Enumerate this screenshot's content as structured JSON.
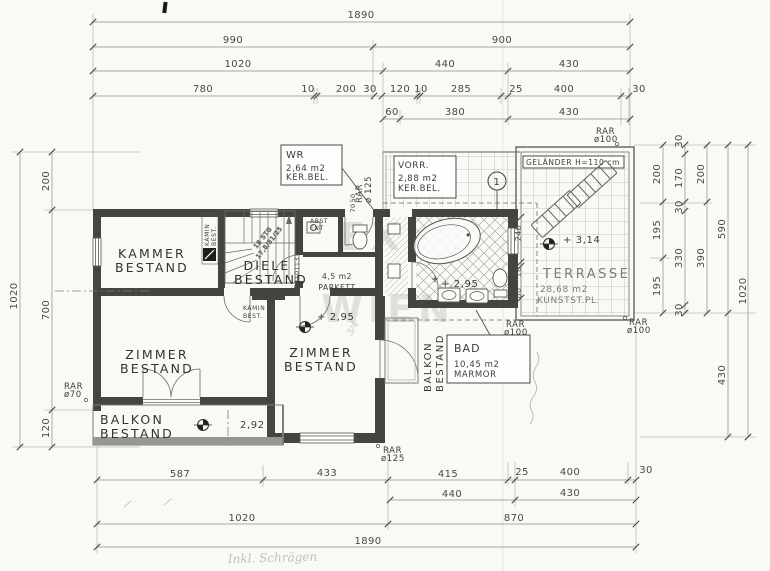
{
  "rooms": {
    "kammer": {
      "lines": [
        "KAMMER",
        "BESTAND"
      ]
    },
    "diele": {
      "lines": [
        "DIELE",
        "BESTAND"
      ]
    },
    "zimmer": {
      "lines": [
        "ZIMMER",
        "BESTAND"
      ]
    },
    "balkon": {
      "lines": [
        "BALKON",
        "BESTAND"
      ]
    },
    "wr": {
      "lines": [
        "WR",
        "2,64 m2",
        "KER.BEL."
      ]
    },
    "vorr": {
      "lines": [
        "VORR.",
        "2,88 m2",
        "KER.BEL."
      ]
    },
    "bad": {
      "lines": [
        "BAD",
        "10,45 m2",
        "MARMOR"
      ]
    },
    "terrasse": {
      "lines": [
        "TERRASSE",
        "28,68 m2",
        "KUNSTST.PL."
      ]
    },
    "flur": {
      "lines": [
        "4,5 m2",
        "PARKETT"
      ]
    }
  },
  "annotations": {
    "gelaender": "GELÄNDER H=110 cm",
    "stairs": [
      "18 STG",
      "17,8/31/25"
    ],
    "kamin": [
      "KAMIN",
      "BEST."
    ],
    "abst": "ABST",
    "ent": "ENT",
    "circle_mark": "1",
    "levels": {
      "terrasse": "+ 3,14",
      "diele": "+ 2,95",
      "bad": "+ 2,95",
      "balkon": "2,92"
    },
    "hand_fraction": "3/4",
    "hand_note": "Inkl. Schrägen"
  },
  "rar": {
    "left": [
      "RAR",
      "ø70"
    ],
    "wr": [
      "RAR",
      "ø 125"
    ],
    "top_right": [
      "RAR",
      "ø100"
    ],
    "terrace": [
      "RAR",
      "ø100"
    ],
    "bad": [
      "RAR",
      "ø100"
    ],
    "bottom": [
      "RAR",
      "ø125"
    ]
  },
  "dims": {
    "t1": [
      "1890"
    ],
    "t2": [
      "990",
      "900"
    ],
    "t3": [
      "1020",
      "440",
      "430"
    ],
    "t4": [
      "780",
      "10",
      "200",
      "30",
      "120",
      "10",
      "285",
      "25",
      "400",
      "30"
    ],
    "t5": [
      "60",
      "380",
      "430"
    ],
    "b1": [
      "587",
      "433",
      "415",
      "25",
      "400",
      "30"
    ],
    "b2": [
      "440",
      "430"
    ],
    "b3": [
      "1020",
      "870"
    ],
    "b4": [
      "1890"
    ],
    "left_outer": [
      "1020"
    ],
    "left_inner": [
      "200",
      "700",
      "120"
    ],
    "r1": [
      "200",
      "195",
      "195"
    ],
    "r2": [
      "30",
      "170",
      "30",
      "330",
      "30"
    ],
    "r3": [
      "200",
      "390"
    ],
    "r4": [
      "590",
      "430"
    ],
    "r5": [
      "1020"
    ],
    "bath": [
      "240",
      "10",
      "80"
    ],
    "corridor": [
      "113",
      "10",
      "72"
    ],
    "wall": [
      "50",
      "70"
    ]
  },
  "watermark": [
    "EX",
    "WIEN"
  ]
}
